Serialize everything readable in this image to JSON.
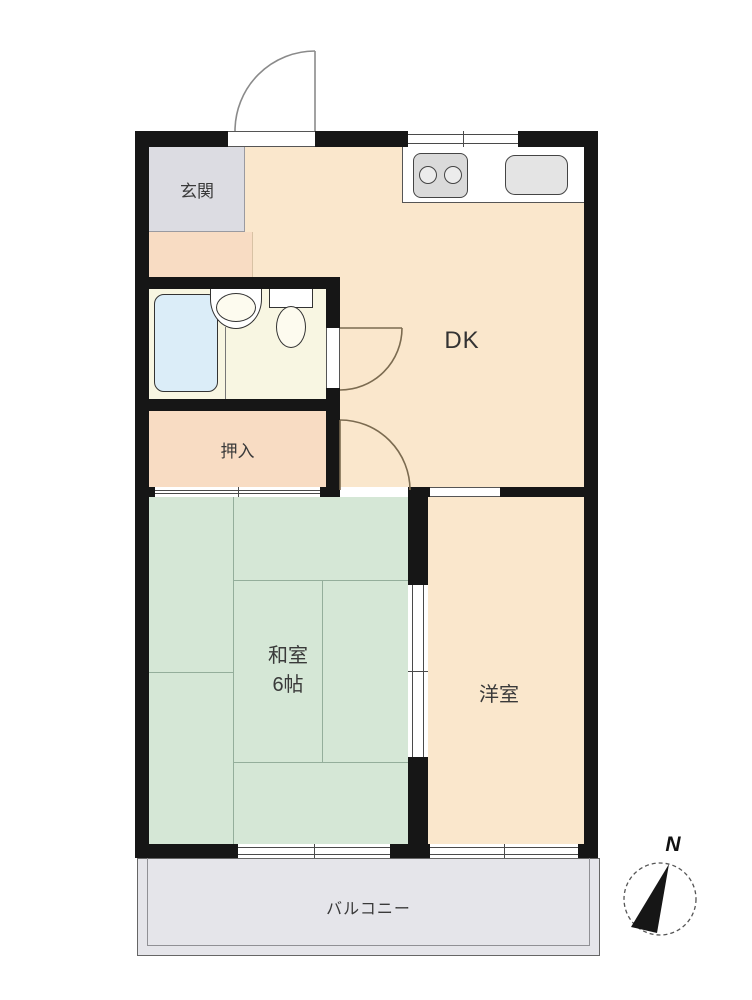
{
  "floorplan": {
    "rooms": {
      "entrance": {
        "label": "玄関",
        "fill": "#DCDCE2"
      },
      "dining_kitchen": {
        "label": "DK",
        "fill": "#FAE7CC"
      },
      "closet": {
        "label": "押入",
        "fill": "#F8DCC3"
      },
      "japanese_room": {
        "name": "和室",
        "size": "6帖",
        "fill": "#D5E7D6"
      },
      "western_room": {
        "label": "洋室",
        "fill": "#FAE7CC"
      },
      "bathroom": {
        "fill": "#F8F6E2",
        "bathtub_fill": "#DBEDF8"
      },
      "balcony": {
        "label": "バルコニー",
        "fill": "#E5E5EA"
      }
    },
    "compass": {
      "north_label": "N"
    },
    "wall_color": "#161616"
  }
}
